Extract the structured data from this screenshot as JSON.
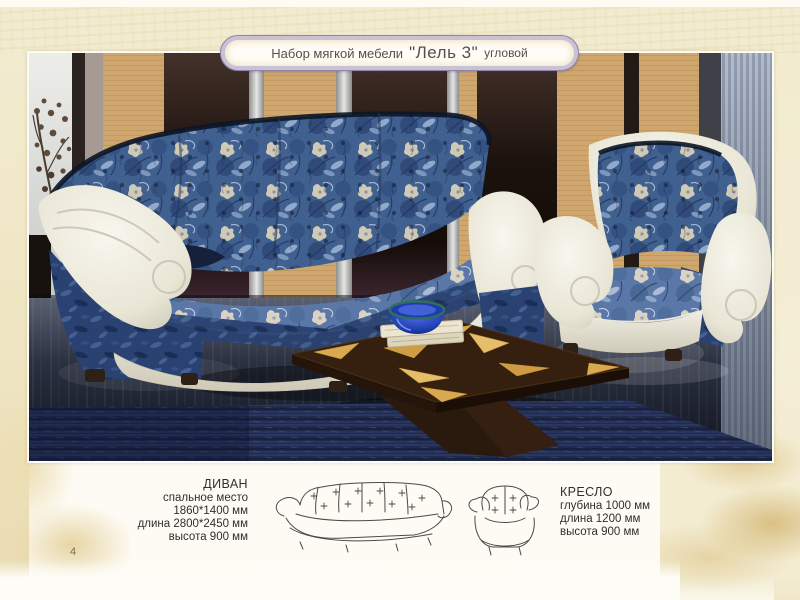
{
  "page": {
    "number": "4",
    "background_color": "#fdfbf4",
    "band_color": "#f2ebcf"
  },
  "banner": {
    "prefix": "Набор мягкой мебели",
    "product_name": "\"Лель 3\"",
    "suffix": "угловой",
    "border_color": "#8f85a8",
    "ring_color": "#c9c2d7",
    "fill_color": "#fffdf5",
    "text_color": "#54504c"
  },
  "photo": {
    "alt": "Диван угловой и кресло «Лель 3» — синяя цветочная обивка с белой кожей, журнальный столик",
    "colors": {
      "fabric_blue": "#40608f",
      "fabric_blue_light": "#5a77a8",
      "velvet_blue": "#2a4272",
      "leather_white": "#ece9db",
      "panel_beige": "#cfa66e",
      "panel_dark": "#1c120d",
      "blinds_gray": "#a3adbe",
      "carpet_navy": "#202a4c",
      "table_brown": "#35200f",
      "table_inlay_gold": "#d9a94f",
      "bowl_blue": "#2e57d8"
    }
  },
  "specs": {
    "sofa": {
      "title": "ДИВАН",
      "lines": [
        "спальное место",
        "1860*1400 мм",
        "длина 2800*2450 мм",
        "высота 900 мм"
      ]
    },
    "armchair": {
      "title": "КРЕСЛО",
      "lines": [
        "глубина 1000 мм",
        "длина 1200 мм",
        "высота 900 мм"
      ]
    }
  }
}
